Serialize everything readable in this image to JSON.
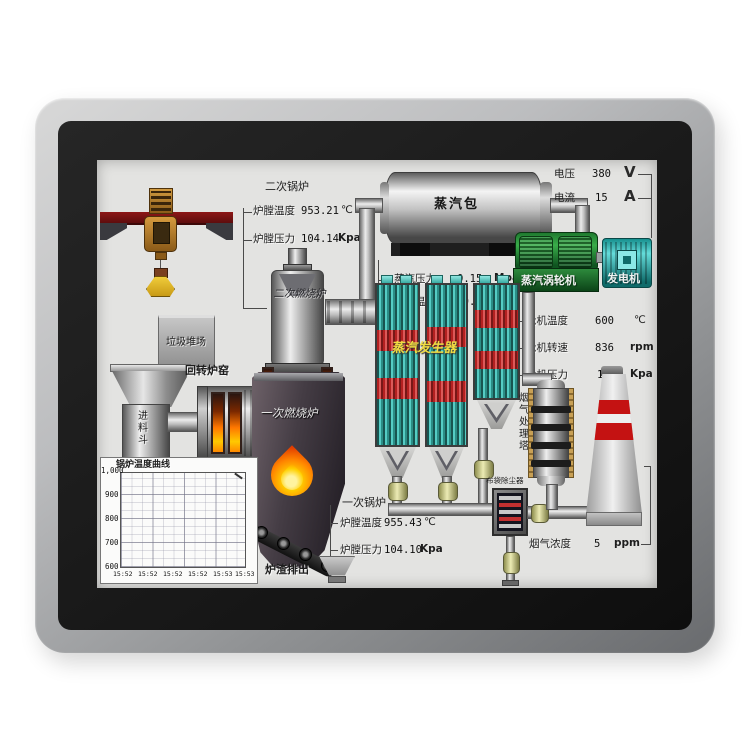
{
  "scada": {
    "secondary_boiler": {
      "title": "二次锅炉",
      "rows": [
        {
          "label": "炉膛温度",
          "value": "953.21",
          "unit": "℃"
        },
        {
          "label": "炉膛压力",
          "value": "104.14",
          "unit": "Kpa"
        }
      ]
    },
    "steam_drum": {
      "label": "蒸汽包",
      "rows": [
        {
          "label": "蒸汽压力",
          "value": "0.15",
          "unit": "Mpa"
        },
        {
          "label": "蒸汽温度",
          "value": "630.00",
          "unit": "℃"
        }
      ]
    },
    "power": {
      "rows": [
        {
          "label": "电压",
          "value": "380",
          "unit": "V"
        },
        {
          "label": "电流",
          "value": "15",
          "unit": "A"
        }
      ]
    },
    "turbine": {
      "label": "蒸汽涡轮机",
      "generator": "发电机",
      "rows": [
        {
          "label": "轮机温度",
          "value": "600",
          "unit": "℃"
        },
        {
          "label": "轮机转速",
          "value": "836",
          "unit": "rpm"
        },
        {
          "label": "轮机压力",
          "value": "10",
          "unit": "Kpa"
        }
      ]
    },
    "primary_boiler": {
      "title": "一次锅炉",
      "rows": [
        {
          "label": "炉膛温度",
          "value": "955.43",
          "unit": "℃"
        },
        {
          "label": "炉膛压力",
          "value": "104.10",
          "unit": "Kpa"
        }
      ]
    },
    "flue_gas": {
      "label": "烟气浓度",
      "value": "5",
      "unit": "ppm"
    },
    "labels": {
      "waste_yard": "垃圾堆场",
      "feed_hopper": "进料斗",
      "rotary_kiln": "回转炉窑",
      "secondary_furnace": "二次燃烧炉",
      "primary_furnace": "一次燃烧炉",
      "steam_generator": "蒸汽发生器",
      "treatment_tower": "烟气处理塔",
      "bag_filter": "布袋除尘器",
      "slag_discharge": "炉渣排出"
    },
    "chart": {
      "title": "锅炉温度曲线",
      "y_ticks": [
        "1,000",
        "900",
        "800",
        "700",
        "600"
      ],
      "x_ticks": [
        "15:52",
        "15:52",
        "15:52",
        "15:52",
        "15:53",
        "15:53"
      ]
    },
    "colors": {
      "turbine_green": "#2e9e40",
      "generator_teal": "#35c4c4",
      "tube_teal": "#55ccc4",
      "tube_red": "#c01c1c",
      "chimney_red": "#c41212",
      "crane_red": "#7a1212",
      "flame_orange": "#ff8400"
    }
  },
  "chart_data": {
    "type": "line",
    "title": "锅炉温度曲线",
    "x": [
      "15:52",
      "15:52",
      "15:52",
      "15:52",
      "15:53",
      "15:53"
    ],
    "y_ticks": [
      600,
      700,
      800,
      900,
      1000
    ],
    "ylim": [
      600,
      1000
    ],
    "series": [
      {
        "name": "锅炉温度",
        "values": []
      }
    ],
    "grid": true,
    "legend": false
  }
}
